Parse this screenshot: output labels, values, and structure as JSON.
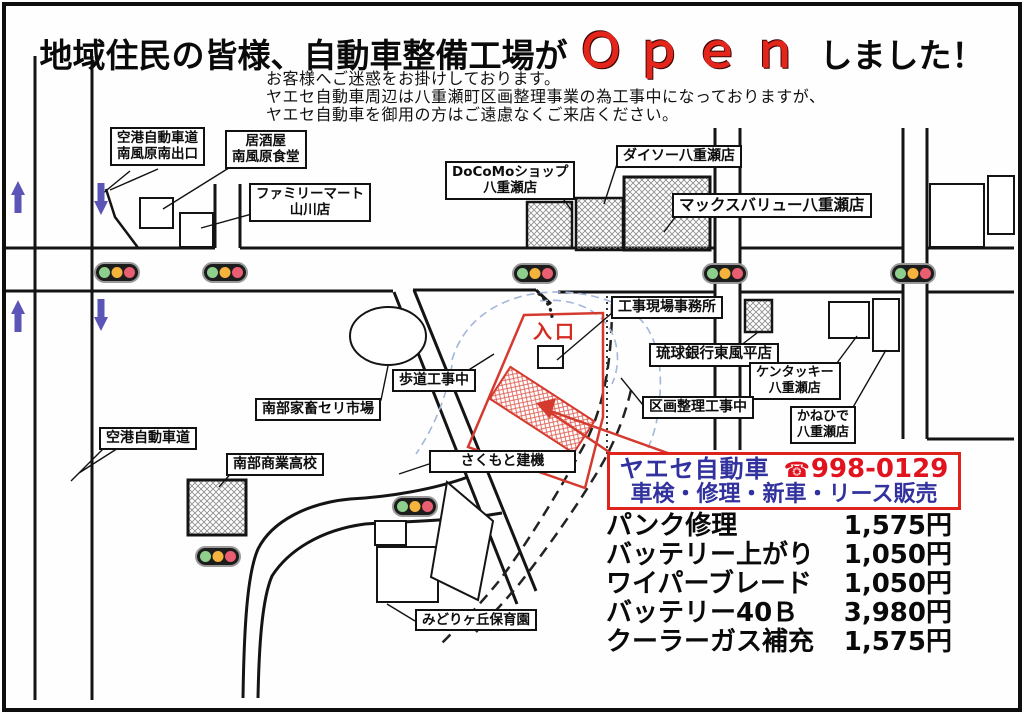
{
  "title": {
    "prefix": "地域住民の皆様、自動車整備工場が",
    "highlight": "Ｏｐｅｎ",
    "suffix": "しました！"
  },
  "notice": {
    "line1": "お客様へご迷惑をお掛けしております。",
    "line2": "ヤエセ自動車周辺は八重瀬町区画整理事業の為工事中になっておりますが、",
    "line3": "ヤエセ自動車を御用の方はご遠慮なくご来店ください。"
  },
  "map": {
    "labels": {
      "airport_exit": "空港自動車道\n南風原南出口",
      "izakaya": "居酒屋\n南風原食堂",
      "familymart": "ファミリーマート\n山川店",
      "docomo": "DoCoMoショップ\n八重瀬店",
      "daiso": "ダイソー八重瀬店",
      "maxvalu": "マックスバリュー八重瀬店",
      "site_office": "工事現場事務所",
      "ryukyu_bank": "琉球銀行東風平店",
      "kfc": "ケンタッキー\n八重瀬店",
      "kanehide": "かねひで\n八重瀬店",
      "kukaku_koji": "区画整理工事中",
      "hodou_koji": "歩道工事中",
      "seri_market": "南部家畜セリ市場",
      "airport_road": "空港自動車道",
      "nanbu_shogyo": "南部商業高校",
      "sakumoto": "さくもと建機",
      "midorigaoka": "みどりヶ丘保育園",
      "entrance": "入口"
    }
  },
  "ad_box": {
    "shop_name": "ヤエセ自動車",
    "phone_icon": "☎",
    "phone": "998-0129",
    "services": "車検・修理・新車・リース販売"
  },
  "price_list": [
    {
      "item": "パンク修理",
      "price": "1,575円"
    },
    {
      "item": "バッテリー上がり",
      "price": "1,050円"
    },
    {
      "item": "ワイパーブレード",
      "price": "1,050円"
    },
    {
      "item": "バッテリー40Ｂ",
      "price": "3,980円"
    },
    {
      "item": "クーラーガス補充",
      "price": "1,575円"
    }
  ],
  "colors": {
    "open_red": "#e4251c",
    "ad_blue": "#32329f",
    "ad_red": "#e0131f",
    "map_red": "#d53a2e",
    "arrow_purple": "#5b55b7",
    "blue_dash": "#a3b6dc",
    "signal_green": "#8ecf8e",
    "signal_yellow": "#f4b33c",
    "signal_red": "#e95e70"
  }
}
